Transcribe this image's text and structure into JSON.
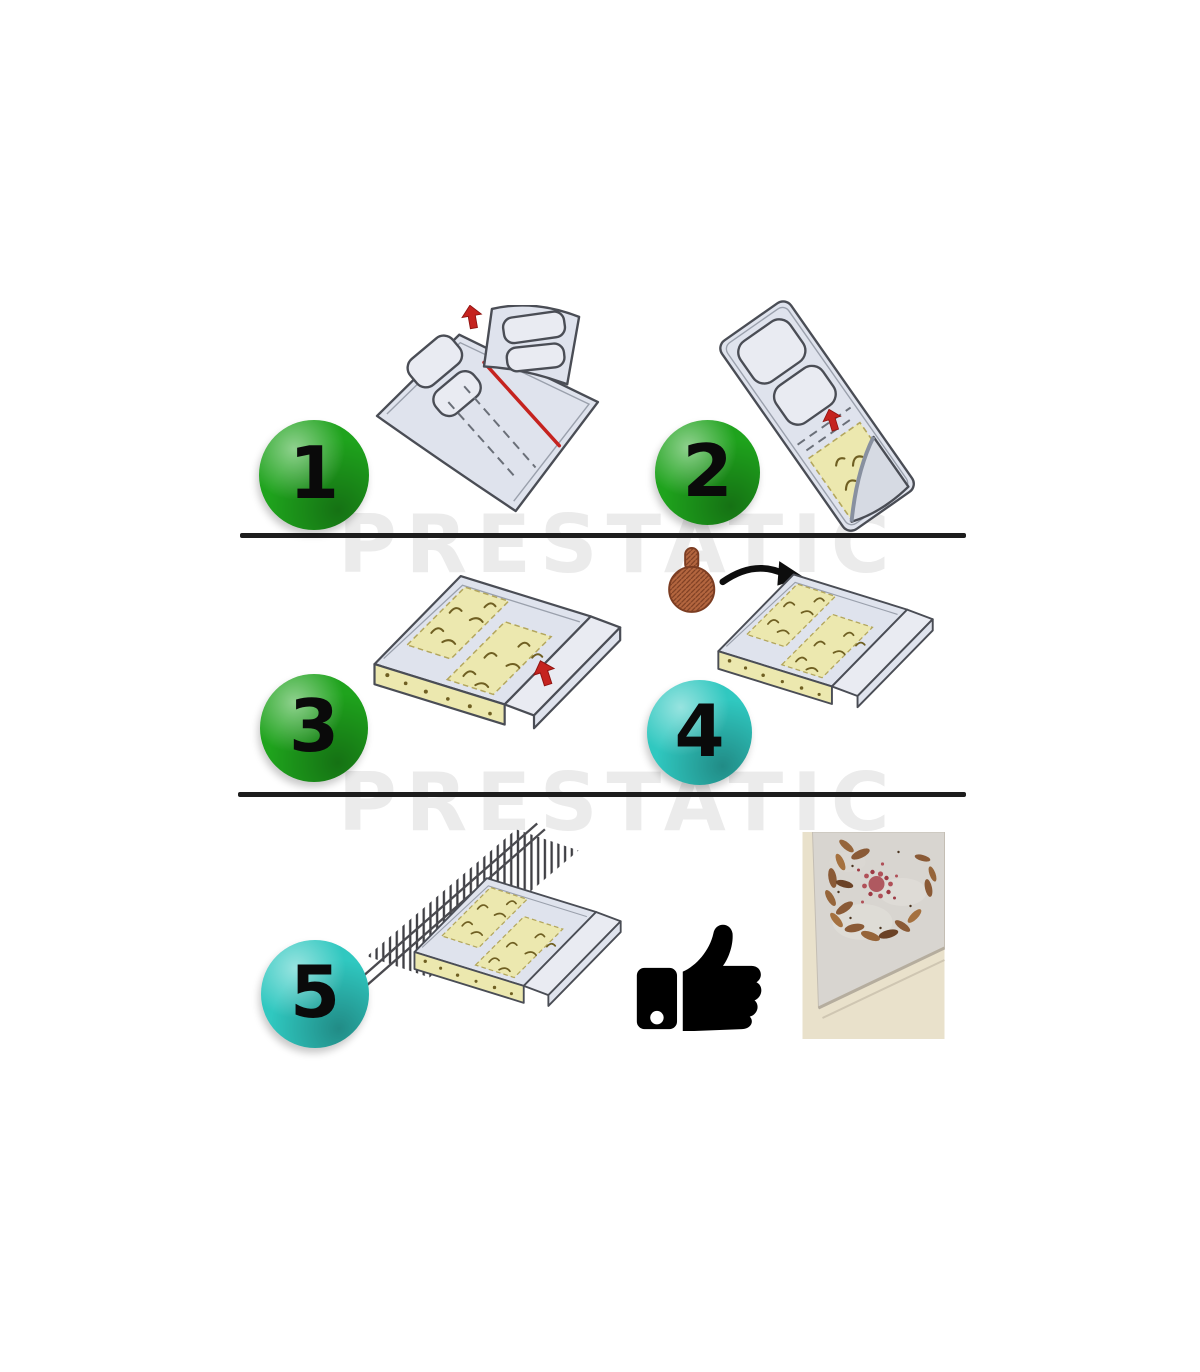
{
  "watermarks": [
    {
      "text": "PRESTATIC"
    },
    {
      "text": "PRESTATIC"
    }
  ],
  "steps": [
    {
      "number": "1",
      "badge_color": "#1fa31d"
    },
    {
      "number": "2",
      "badge_color": "#1fa31d"
    },
    {
      "number": "3",
      "badge_color": "#1fa31d"
    },
    {
      "number": "4",
      "badge_color": "#30c8c0"
    },
    {
      "number": "5",
      "badge_color": "#30c8c0"
    }
  ],
  "icons": {
    "red_arrow": "red-arrow-up-icon",
    "bait_capsule": "bait-capsule-icon",
    "curved_arrow": "curved-arrow-icon",
    "thumbs_up": "thumbs-up-icon",
    "result_photo": "cockroaches-on-glue-board-photo"
  },
  "colors": {
    "badge_text": "#0a0a0a",
    "divider": "#1d1d1d",
    "watermark": "#ebebeb",
    "sheet_fill": "#dfe3ed",
    "sheet_fill_light": "#e9ebf2",
    "sheet_stroke": "#4a4d55",
    "inner_line": "#9aa0ac",
    "glue_fill": "#ece8af",
    "glue_stroke": "#b3a65c",
    "squiggle": "#6f5f22",
    "accent_red": "#c5231f",
    "bait_fill": "#b4663f",
    "bait_stroke": "#7c3d22",
    "arrow_black": "#0d0d0d",
    "thumb_black": "#000000",
    "wall_hatch": "#3f3f44",
    "photo_bg": "#e9e1cb",
    "photo_board": "#d8d5d0",
    "photo_bait": "#a8434c",
    "photo_roach": "#8a5a36"
  }
}
